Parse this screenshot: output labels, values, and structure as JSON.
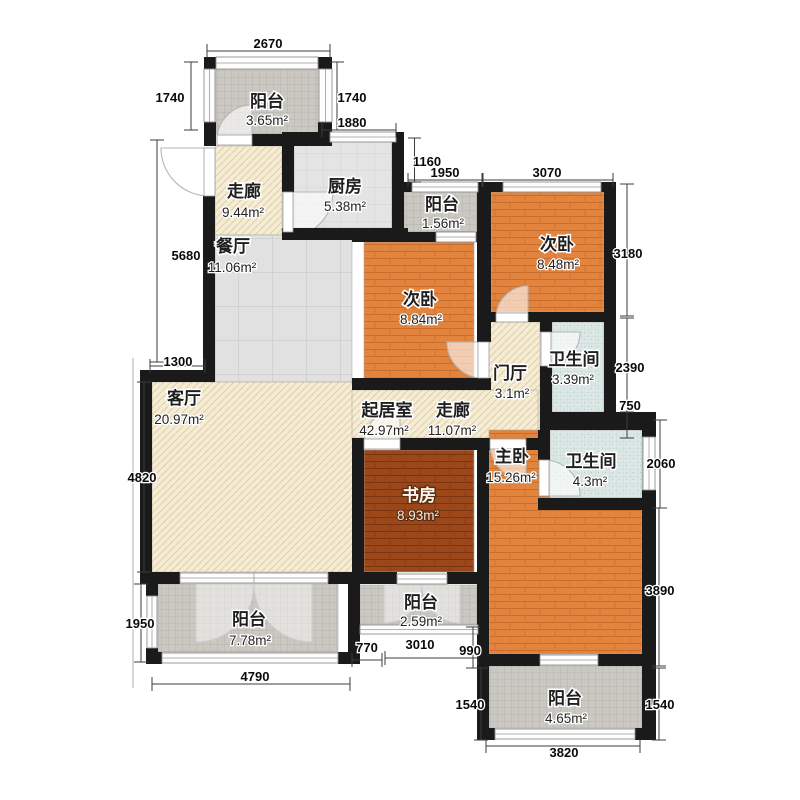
{
  "plan": {
    "type": "apartment-floorplan",
    "area_unit": "m²",
    "length_unit": "mm"
  },
  "palette": {
    "wall": "#1a1a1a",
    "wood_floor": "#e2833e",
    "wood_dark_floor": "#9b4719",
    "cream_floor": "#f5ecd3",
    "tile_floor": "#e1e1e1",
    "bath_floor": "#dce8e6",
    "balcony_floor": "#cbc8c2",
    "dim_text": "#0a0a0a"
  },
  "rooms": [
    {
      "name": "阳台",
      "area": "3.65m²"
    },
    {
      "name": "走廊",
      "area": "9.44m²"
    },
    {
      "name": "厨房",
      "area": "5.38m²"
    },
    {
      "name": "餐厅",
      "area": "11.06m²"
    },
    {
      "name": "阳台",
      "area": "1.56m²"
    },
    {
      "name": "次卧",
      "area": "8.48m²"
    },
    {
      "name": "次卧",
      "area": "8.84m²"
    },
    {
      "name": "门厅",
      "area": "3.1m²"
    },
    {
      "name": "卫生间",
      "area": "3.39m²"
    },
    {
      "name": "客厅",
      "area": "20.97m²"
    },
    {
      "name": "起居室",
      "area": "42.97m²"
    },
    {
      "name": "走廊",
      "area": "11.07m²"
    },
    {
      "name": "主卧",
      "area": "15.26m²"
    },
    {
      "name": "卫生间",
      "area": "4.3m²"
    },
    {
      "name": "书房",
      "area": "8.93m²"
    },
    {
      "name": "阳台",
      "area": "7.78m²"
    },
    {
      "name": "阳台",
      "area": "2.59m²"
    },
    {
      "name": "阳台",
      "area": "4.65m²"
    }
  ],
  "dims": [
    "2670",
    "1740",
    "1740",
    "1880",
    "1160",
    "1950",
    "3070",
    "3180",
    "5680",
    "1300",
    "2390",
    "750",
    "2060",
    "4820",
    "1950",
    "4790",
    "770",
    "3010",
    "990",
    "3890",
    "1540",
    "1540",
    "3820"
  ]
}
